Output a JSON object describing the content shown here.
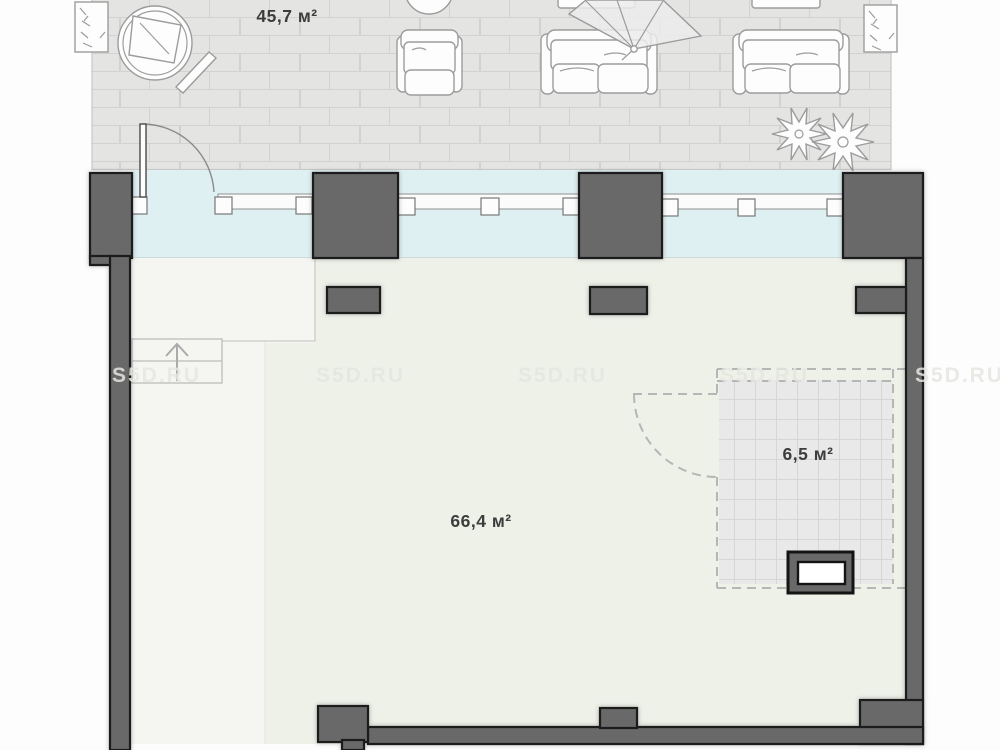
{
  "plan": {
    "watermark": "S5D.RU",
    "areas": {
      "terrace": "45,7 м²",
      "living_room": "66,4 м²",
      "planned_room": "6,5 м²"
    },
    "icons": {
      "planter_box": "sketched-plant-rectangle",
      "round_table": "concentric-circles-with-napkin",
      "armchair": "top-view-armchair",
      "sofa": "top-view-two-seat-sofa",
      "sun_umbrella": "tilted-parasol-canopy",
      "plants": "star-shaped-shrubs",
      "stairs": "steps-with-up-arrow",
      "door_swing": "quarter-circle-arc",
      "vent_shaft": "dark-block-with-white-core"
    },
    "colors": {
      "wall": "#696969",
      "wall_outline": "#1d1d1d",
      "glazing": "#dff0f2",
      "terrace_tile": "#e4e4e3",
      "terrace_tile_line": "#d2d2d1",
      "floor_main": "#edf1e8",
      "floor_light": "#f5f5f2",
      "planned_tile": "#e9e9e9",
      "dashed_line": "#b6b6b6",
      "label_text": "#3d3d3d",
      "watermark_text": "#e6e6e2"
    }
  }
}
